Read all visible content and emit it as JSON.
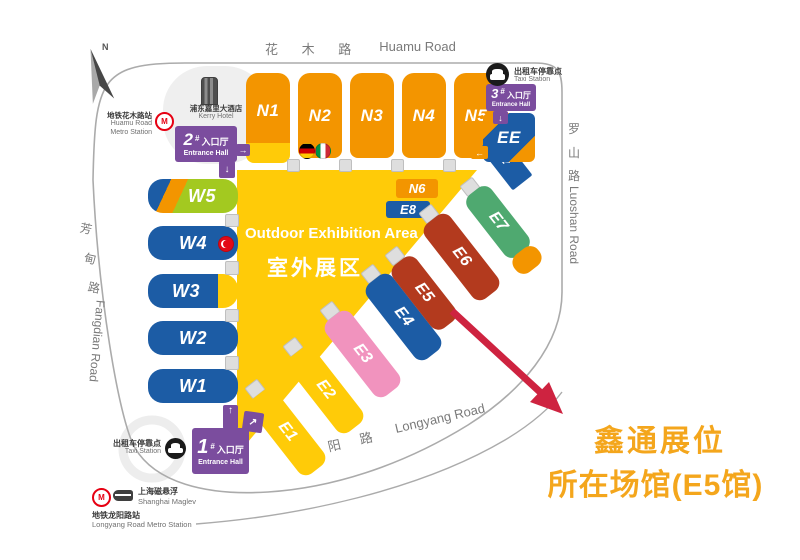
{
  "halls": {
    "n1": "N1",
    "n2": "N2",
    "n3": "N3",
    "n4": "N4",
    "n5": "N5",
    "n6": "N6",
    "w1": "W1",
    "w2": "W2",
    "w3": "W3",
    "w4": "W4",
    "w5": "W5",
    "e1": "E1",
    "e2": "E2",
    "e3": "E3",
    "e4": "E4",
    "e5": "E5",
    "e6": "E6",
    "e7": "E7",
    "e8": "E8",
    "ee": "EE"
  },
  "outdoor": {
    "en": "Outdoor Exhibition Area",
    "zh": "室外展区"
  },
  "roads": {
    "huamu": {
      "zh": "花 木 路",
      "en": "Huamu Road"
    },
    "luoshan": {
      "zh1": "罗",
      "zh2": "山",
      "zh3": "路",
      "en": "Luoshan Road"
    },
    "fangdian": {
      "zh1": "芳",
      "zh2": "甸",
      "zh3": "路",
      "en": "Fangdian Road"
    },
    "longyang": {
      "zh": "龙 阳 路",
      "en": "Longyang Road"
    }
  },
  "north": {
    "label": "N"
  },
  "landmarks": {
    "kerry": {
      "zh": "浦东嘉里大酒店",
      "en": "Kerry Hotel"
    },
    "huamu_metro": {
      "zh": "地铁花木路站",
      "en1": "Huamu Road",
      "en2": "Metro Station"
    },
    "taxi_top": {
      "zh": "出租车停靠点",
      "en": "Taxi Station"
    },
    "taxi_bottom": {
      "zh": "出租车停靠点",
      "en": "Taxi Station"
    },
    "maglev": {
      "zh": "上海磁悬浮",
      "en": "Shanghai Maglev"
    },
    "longyang_metro": {
      "zh": "地铁龙阳路站",
      "en": "Longyang Road Metro Station"
    }
  },
  "entrances": {
    "one": {
      "num": "1",
      "hash": "#",
      "zh": "入口厅",
      "en": "Entrance Hall"
    },
    "two": {
      "num": "2",
      "hash": "#",
      "zh": "入口厅",
      "en": "Entrance Hall"
    },
    "three": {
      "num": "3",
      "hash": "#",
      "zh": "入口厅",
      "en": "Entrance Hall"
    }
  },
  "annotation": {
    "line1": "鑫通展位",
    "line2": "所在场馆(E5馆)"
  },
  "colors": {
    "orange": "#F39500",
    "yellow": "#FFCB08",
    "blue": "#1C5CA5",
    "lime": "#A3C920",
    "green": "#4FA970",
    "hall_red": "#B33A1E",
    "pink": "#F193BE",
    "purple": "#7B4D9E",
    "arrow_red": "#CE2340",
    "annotation": "#F4A61C",
    "road_gray": "#7A7A7A"
  }
}
